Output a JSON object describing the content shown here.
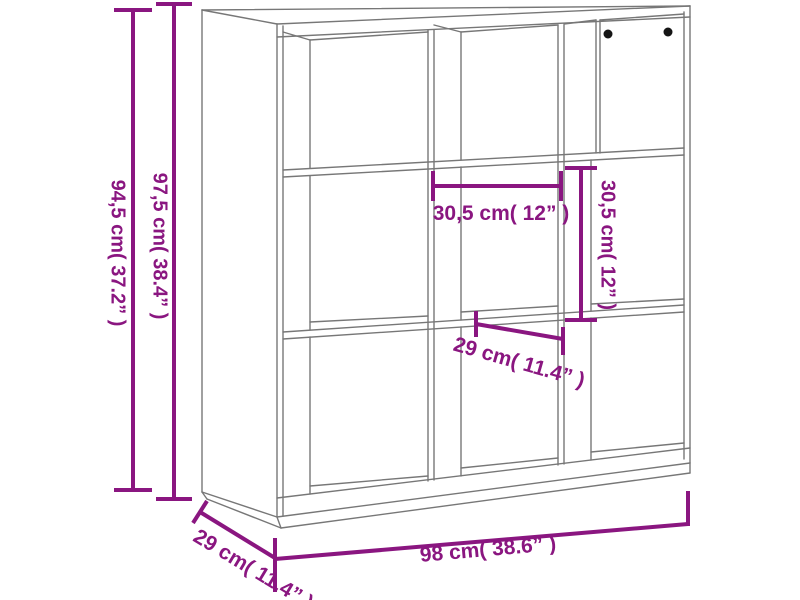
{
  "colors": {
    "dimension": "#8a1680",
    "line_art": "#777777",
    "hole_dots": "#151515",
    "background": "#ffffff"
  },
  "figure": {
    "title": "9-cube book cabinet dimension line drawing",
    "labels": {
      "height_side": "94,5 cm( 37.2” )",
      "height_total": "97,5 cm( 38.4” )",
      "inner_width": "30,5 cm( 12” )",
      "inner_height": "30,5 cm( 12” )",
      "shelf_depth": "29 cm( 11.4” )",
      "total_width": "98 cm( 38.6” )",
      "base_depth": "29 cm( 11.4” )"
    }
  }
}
